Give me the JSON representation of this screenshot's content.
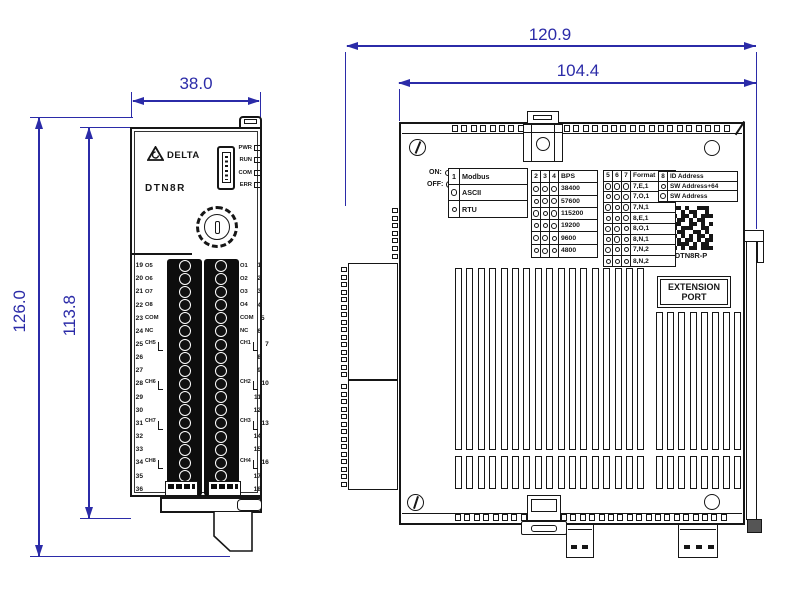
{
  "colors": {
    "ink": "#161616",
    "dimension": "#2b2ba8"
  },
  "front_view": {
    "width_dim": "38.0",
    "height_outer_dim": "126.0",
    "height_inner_dim": "113.8",
    "brand": "DELTA",
    "model": "DTN8R",
    "leds": [
      "PWR",
      "RUN",
      "COM",
      "ERR"
    ],
    "left_terminals": [
      {
        "num": "19",
        "label": "O5"
      },
      {
        "num": "20",
        "label": "O6"
      },
      {
        "num": "21",
        "label": "O7"
      },
      {
        "num": "22",
        "label": "O8"
      },
      {
        "num": "23",
        "label": "COM"
      },
      {
        "num": "24",
        "label": "NC"
      },
      {
        "num": "25",
        "label": "CH5"
      },
      {
        "num": "26",
        "label": ""
      },
      {
        "num": "27",
        "label": ""
      },
      {
        "num": "28",
        "label": "CH6"
      },
      {
        "num": "29",
        "label": ""
      },
      {
        "num": "30",
        "label": ""
      },
      {
        "num": "31",
        "label": "CH7"
      },
      {
        "num": "32",
        "label": ""
      },
      {
        "num": "33",
        "label": ""
      },
      {
        "num": "34",
        "label": "CH8"
      },
      {
        "num": "35",
        "label": ""
      },
      {
        "num": "36",
        "label": ""
      }
    ],
    "right_terminals": [
      {
        "label": "O1",
        "num": "1"
      },
      {
        "label": "O2",
        "num": "2"
      },
      {
        "label": "O3",
        "num": "3"
      },
      {
        "label": "O4",
        "num": "4"
      },
      {
        "label": "COM",
        "num": "5"
      },
      {
        "label": "NC",
        "num": "6"
      },
      {
        "label": "CH1",
        "num": "7"
      },
      {
        "label": "",
        "num": "8"
      },
      {
        "label": "",
        "num": "9"
      },
      {
        "label": "CH2",
        "num": "10"
      },
      {
        "label": "",
        "num": "11"
      },
      {
        "label": "",
        "num": "12"
      },
      {
        "label": "CH3",
        "num": "13"
      },
      {
        "label": "",
        "num": "14"
      },
      {
        "label": "",
        "num": "15"
      },
      {
        "label": "CH4",
        "num": "16"
      },
      {
        "label": "",
        "num": "17"
      },
      {
        "label": "",
        "num": "18"
      }
    ]
  },
  "side_view": {
    "width_outer_dim": "120.9",
    "width_inner_dim": "104.4",
    "legend": {
      "on": "ON:",
      "off": "OFF:"
    },
    "dip_tables": [
      {
        "name": "modbus",
        "header": [
          "1",
          "Modbus"
        ],
        "rows": [
          {
            "states": [
              "off"
            ],
            "label": "ASCII"
          },
          {
            "states": [
              "on"
            ],
            "label": "RTU"
          }
        ]
      },
      {
        "name": "baud-rate",
        "header": [
          "2",
          "3",
          "4",
          "BPS"
        ],
        "rows": [
          {
            "states": [
              "off",
              "off",
              "off"
            ],
            "label": "38400"
          },
          {
            "states": [
              "on",
              "off",
              "off"
            ],
            "label": "57600"
          },
          {
            "states": [
              "off",
              "on",
              "off"
            ],
            "label": "115200"
          },
          {
            "states": [
              "on",
              "on",
              "off"
            ],
            "label": "19200"
          },
          {
            "states": [
              "off",
              "off",
              "on"
            ],
            "label": "9600"
          },
          {
            "states": [
              "on",
              "off",
              "on"
            ],
            "label": "4800"
          }
        ]
      },
      {
        "name": "format",
        "header": [
          "5",
          "6",
          "7",
          "Format"
        ],
        "rows": [
          {
            "states": [
              "off",
              "off",
              "off"
            ],
            "label": "7,E,1"
          },
          {
            "states": [
              "on",
              "off",
              "off"
            ],
            "label": "7,O,1"
          },
          {
            "states": [
              "off",
              "on",
              "off"
            ],
            "label": "7,N,1"
          },
          {
            "states": [
              "on",
              "on",
              "off"
            ],
            "label": "8,E,1"
          },
          {
            "states": [
              "off",
              "off",
              "on"
            ],
            "label": "8,O,1"
          },
          {
            "states": [
              "on",
              "off",
              "on"
            ],
            "label": "8,N,1"
          },
          {
            "states": [
              "off",
              "on",
              "on"
            ],
            "label": "7,N,2"
          },
          {
            "states": [
              "on",
              "on",
              "on"
            ],
            "label": "8,N,2"
          }
        ]
      },
      {
        "name": "id-address",
        "header": [
          "8",
          "ID Address"
        ],
        "rows": [
          {
            "states": [
              "on"
            ],
            "label": "SW Address+64"
          },
          {
            "states": [
              "off"
            ],
            "label": "SW Address"
          }
        ]
      }
    ],
    "qr_label": "DTN8R-P",
    "extension_port_lines": [
      "EXTENSION",
      "PORT"
    ]
  }
}
